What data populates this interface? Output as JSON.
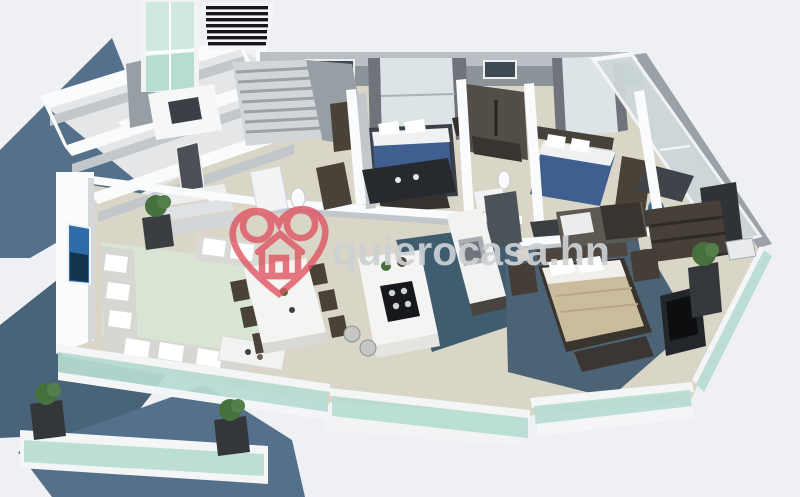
{
  "meta": {
    "type": "3d-floor-plan-rendering",
    "description": "Isometric 3D render of a multi-bedroom apartment floor plan with furnished rooms, glass balconies and a real-estate watermark"
  },
  "watermark": {
    "text": "quierocasa.hn",
    "logo": "heart-house-icon"
  },
  "rooms": [
    "unfurnished left wing rooms",
    "staircase",
    "bedroom with blue bed",
    "shared bathroom with shower",
    "second bedroom with blue bed",
    "study with desk, chair and TV",
    "living room with sectional sofa and wall art",
    "dining area with table and chairs",
    "kitchen with island cooktop and sink counter",
    "master bedroom with tan bed and TV wall",
    "walk-in closet",
    "terrace and balconies with glass railings and planters"
  ],
  "palette": {
    "background": "#eef0f3",
    "shadow-blue": "#54708a",
    "shadow-blue-dark": "#496379",
    "floor-beige": "#d9d5c7",
    "floor-pale": "#e4e6e7",
    "wall-white": "#fafbfc",
    "wall-face": "#c2c7cb",
    "wall-gray": "#8d9499",
    "dark-wall": "#3c4046",
    "wood-dark": "#4a4138",
    "glass-green": "#b7dcd2",
    "glass-pale": "#cfe8e2",
    "window-bright": "#dde4e8",
    "kitchen-floor": "#405d70",
    "master-floor": "#4b6374",
    "bed-blue": "#3f5f91",
    "bed-tan": "#ccbc9e",
    "sofa-gray": "#d6d7d3",
    "rug-green": "#d8e4d4",
    "art-blue": "#2f6da8",
    "wm-pink": "#e0525f",
    "wm-gray": "#cdd1d4"
  }
}
